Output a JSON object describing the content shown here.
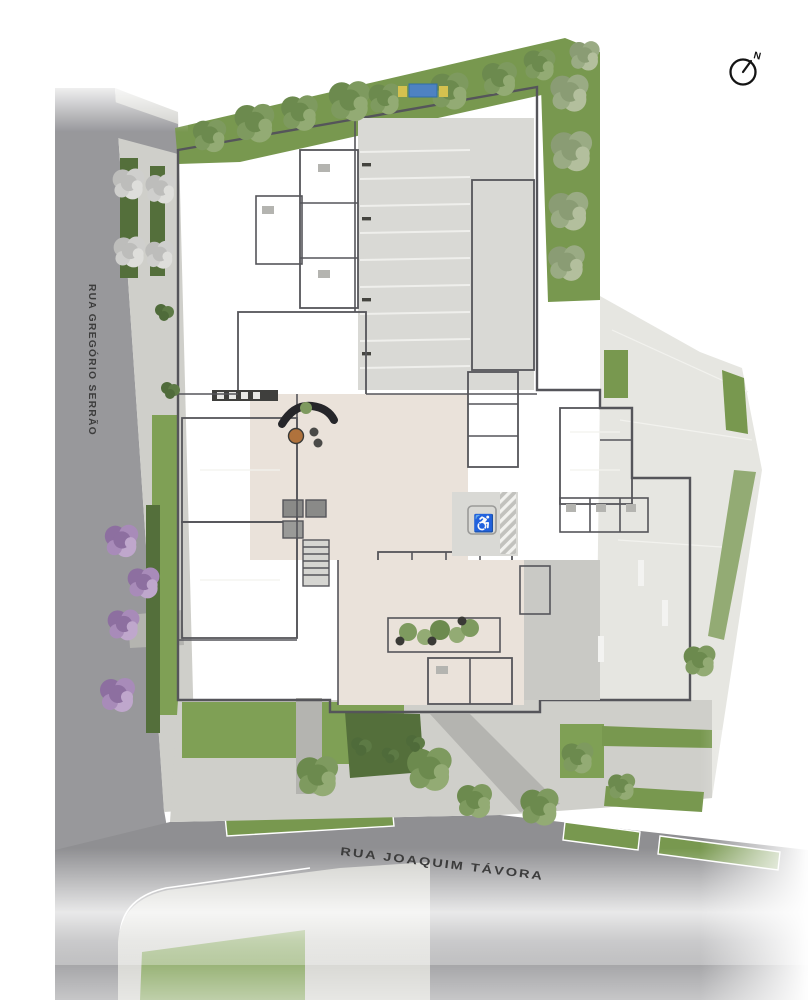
{
  "plan": {
    "streets": {
      "left": "RUA GREGÓRIO SERRÃO",
      "bottom": "RUA JOAQUIM TÁVORA"
    },
    "compass": {
      "north_label": "N"
    },
    "icons": {
      "accessible_parking": "♿",
      "north_arrow": "compass circle with needle pointing north"
    },
    "palette": {
      "road": "#98989b",
      "roadDark": "#8f8f92",
      "sidewalk": "#cfcfca",
      "paving": "#e6e6e1",
      "parkingFloor": "#d9d9d5",
      "buildingFloor": "#c9c9c5",
      "buildingDark": "#b4b4b0",
      "roomWhite": "#f3f3f1",
      "wall": "#55555a",
      "ramp": "#6a6a68",
      "lobby": "#eae2da",
      "grass": "#78984f",
      "lawn": "#7fa055",
      "hedge": "#546f3b",
      "treeGreen": "#7e9a5f",
      "treeGreenDark": "#6c8a4e",
      "treeGreenLight": "#93ab74",
      "treeGrayGreen": "#9aab84",
      "treeGray": "#cfcfcd",
      "treePurple": "#a88bb9",
      "planterStone": "#d8d0c6",
      "potDark": "#3a3a36",
      "pool": "#4e82c2",
      "accentYellow": "#d4c14f",
      "labelText": "#3c3c3c"
    }
  }
}
